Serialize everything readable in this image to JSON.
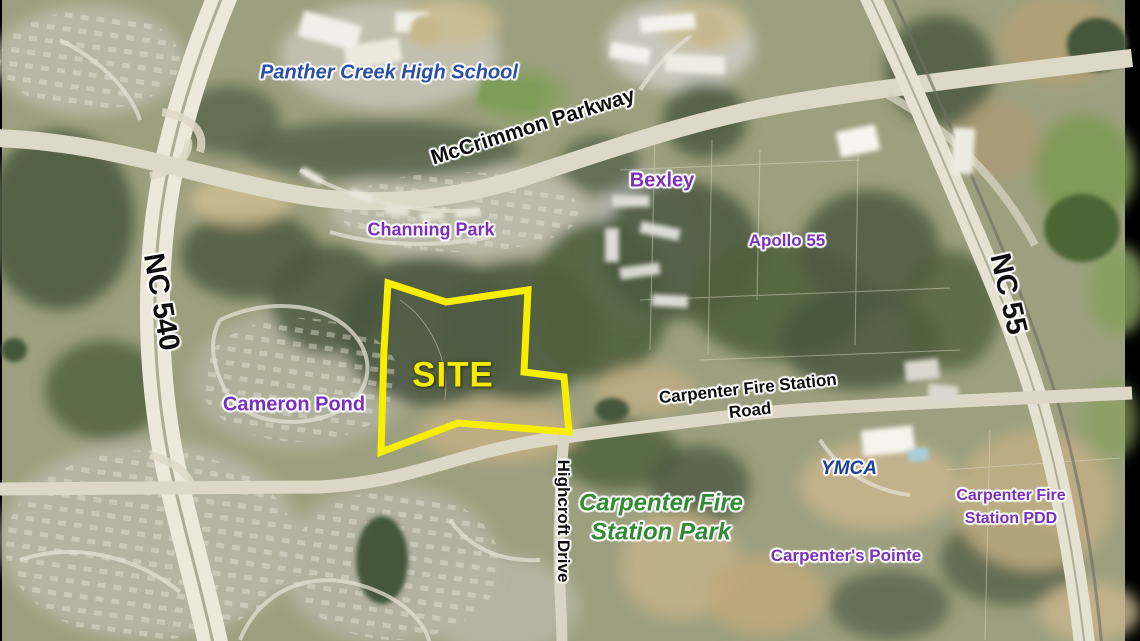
{
  "map": {
    "description": "Aerial site-location map with annotated roads, neighborhoods and a highlighted site boundary",
    "site_outline_color": "#f8ef00",
    "labels": {
      "school": {
        "text": "Panther Creek High School",
        "color": "#2a4fa7"
      },
      "mccrimmon": {
        "text": "McCrimmon Parkway",
        "color": "#0d0d0d"
      },
      "bexley": {
        "text": "Bexley",
        "color": "#7b2fbf"
      },
      "channing_park": {
        "text": "Channing Park",
        "color": "#7b2fbf"
      },
      "apollo_55": {
        "text": "Apollo 55",
        "color": "#7b2fbf"
      },
      "nc540": {
        "text": "NC 540",
        "color": "#0d0d0d"
      },
      "nc55": {
        "text": "NC 55",
        "color": "#0d0d0d"
      },
      "site": {
        "text": "SITE",
        "color": "#f4eb00"
      },
      "cameron_pond": {
        "text": "Cameron Pond",
        "color": "#7b2fbf"
      },
      "cfs_road": {
        "line1": "Carpenter Fire Station",
        "line2": "Road",
        "color": "#0d0d0d"
      },
      "highcroft": {
        "text": "Highcroft Drive",
        "color": "#0d0d0d"
      },
      "ymca": {
        "text": "YMCA",
        "color": "#1c3f9e"
      },
      "cfs_park": {
        "line1": "Carpenter Fire",
        "line2": "Station Park",
        "color": "#2e8b33"
      },
      "cfs_pdd": {
        "line1": "Carpenter Fire",
        "line2": "Station PDD",
        "color": "#7b2fbf"
      },
      "carpenters_pointe": {
        "text": "Carpenter's Pointe",
        "color": "#7b2fbf"
      }
    }
  }
}
